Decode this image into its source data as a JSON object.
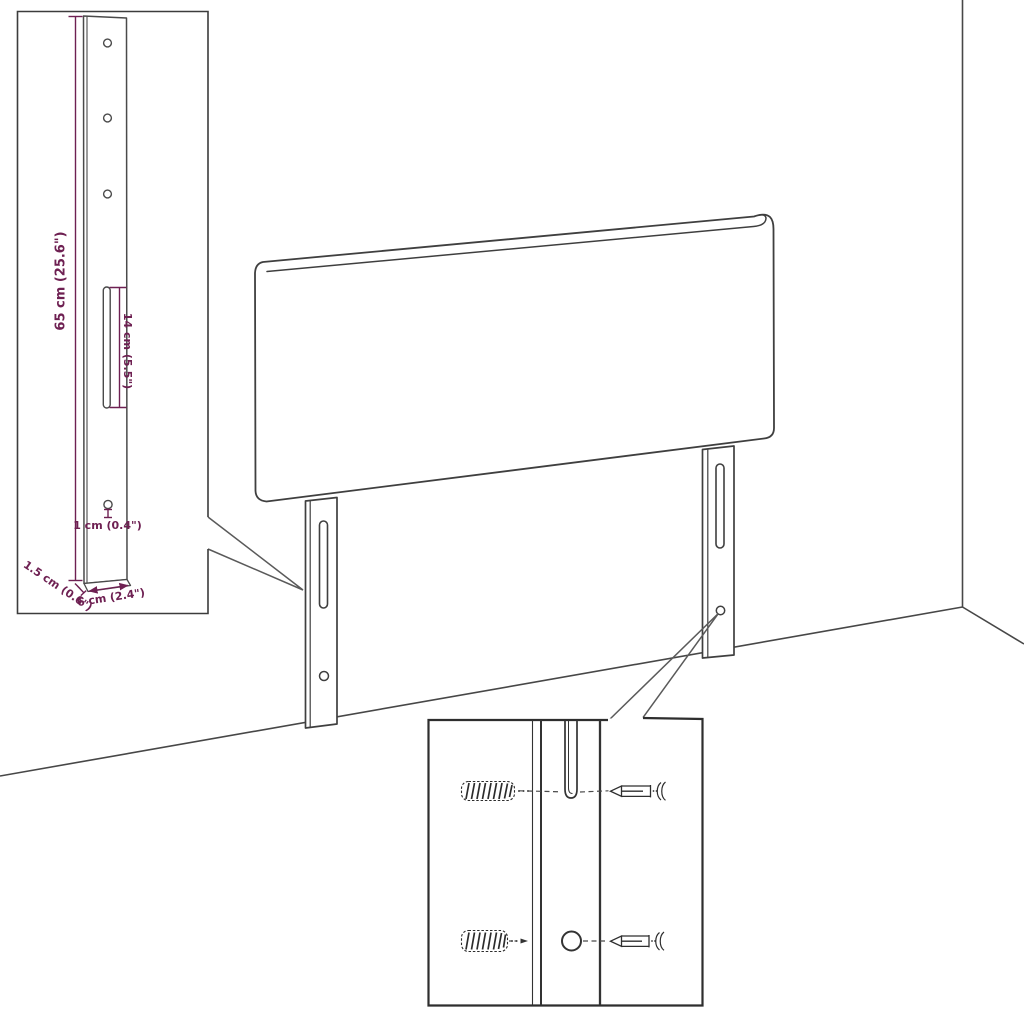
{
  "diagram": {
    "colors": {
      "background": "#ffffff",
      "outline": "#3f3f3f",
      "inset_border": "#2e2e2e",
      "dimension": "#6e2052"
    },
    "bracket_inset": {
      "height_label": "65 cm (25.6\")",
      "slot_label": "14 cm (5.5\")",
      "hole_label": "1 cm (0.4\")",
      "thickness_label": "1.5 cm (0.6\")",
      "width_label": "6 cm (2.4\")",
      "round_holes": 3,
      "small_holes": 1,
      "slots": 1
    },
    "main_view": {
      "legs": 2,
      "leg_slots": 2,
      "leg_holes": 2
    },
    "fixings_inset": {
      "wall_plugs": 2,
      "screws": 2
    }
  }
}
